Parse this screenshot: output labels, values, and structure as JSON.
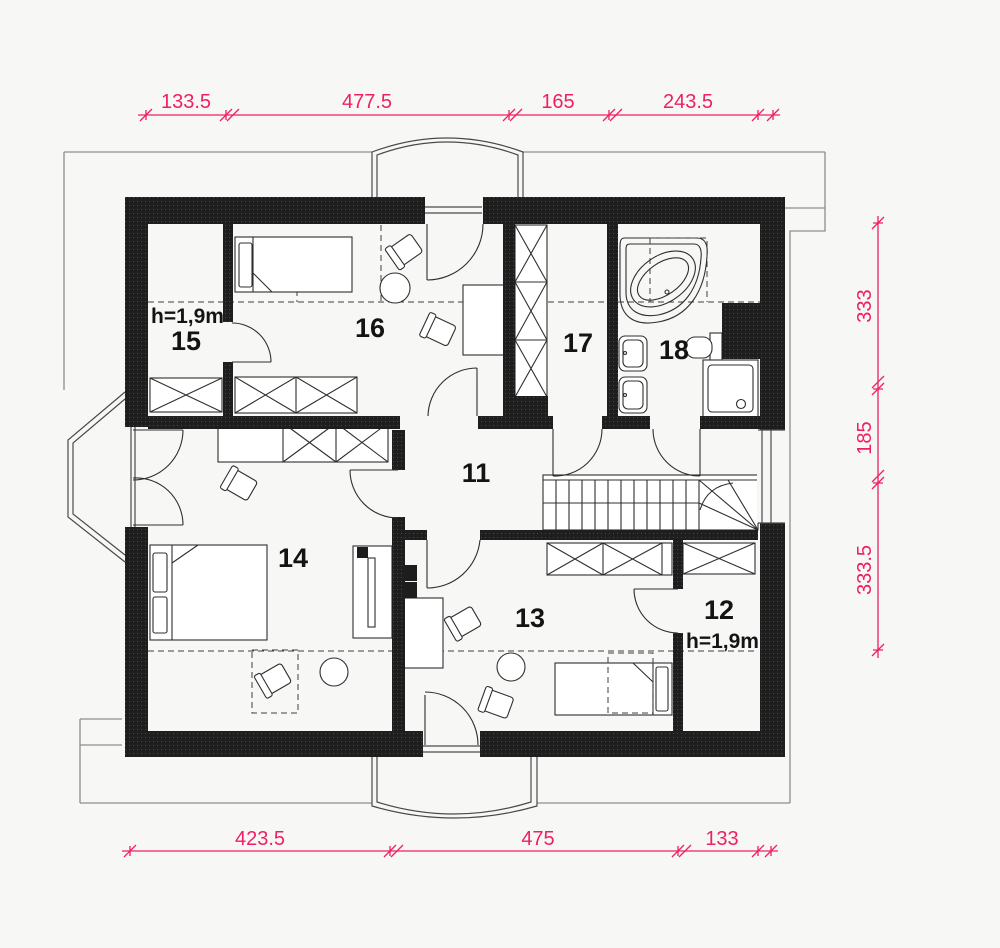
{
  "plan": {
    "kind": "floor-plan",
    "storey": "attic"
  },
  "rooms": [
    {
      "id": "11"
    },
    {
      "id": "12"
    },
    {
      "id": "13"
    },
    {
      "id": "14"
    },
    {
      "id": "15"
    },
    {
      "id": "16"
    },
    {
      "id": "17"
    },
    {
      "id": "18"
    }
  ],
  "height_notes": [
    "h=1,9m",
    "h=1,9m"
  ],
  "dimensions": {
    "top": [
      "133.5",
      "477.5",
      "165",
      "243.5"
    ],
    "bottom": [
      "423.5",
      "475",
      "133"
    ],
    "right": [
      "333",
      "185",
      "333.5"
    ]
  },
  "fixtures": [
    "corner-bathtub",
    "washbasin",
    "washbasin",
    "toilet",
    "shower-cabin",
    "staircase",
    "double-bed",
    "single-bed",
    "single-bed",
    "wardrobe",
    "armchair",
    "round-table",
    "desk",
    "tv-cabinet",
    "bay-window",
    "dormer-window",
    "dormer-window",
    "window"
  ],
  "colors": {
    "dimension_pink": "#ee1f66",
    "wall_black": "#1d1d1d",
    "background": "#f7f8f5",
    "roof_outline_gray": "#8d8d8d"
  }
}
